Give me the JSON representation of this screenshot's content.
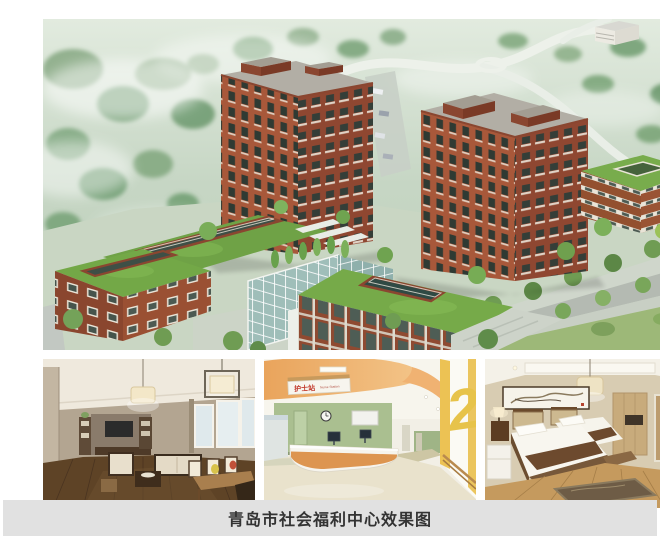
{
  "caption": {
    "text": "青岛市社会福利中心效果图"
  },
  "nurse_station": {
    "sign_cn": "护士站",
    "sign_en": "Nurse Station",
    "floor_number": "2"
  },
  "palette": {
    "caption_bg": "#e1e1e1",
    "caption_text": "#333333",
    "brick_light": "#a8583a",
    "brick_dark": "#8f4731",
    "roof_green": "#74a945",
    "glass_teal": "#9fbeb9",
    "accent_orange": "#e9a45c",
    "desk_orange": "#dd9550",
    "accent_yellow": "#e7c34a",
    "wall_green": "#aabf90",
    "mist_green": "#c9d6c3",
    "wood_floor_dark": "#5e4326",
    "wood_floor_light": "#c59a5e",
    "sign_red": "#c23b2e"
  }
}
